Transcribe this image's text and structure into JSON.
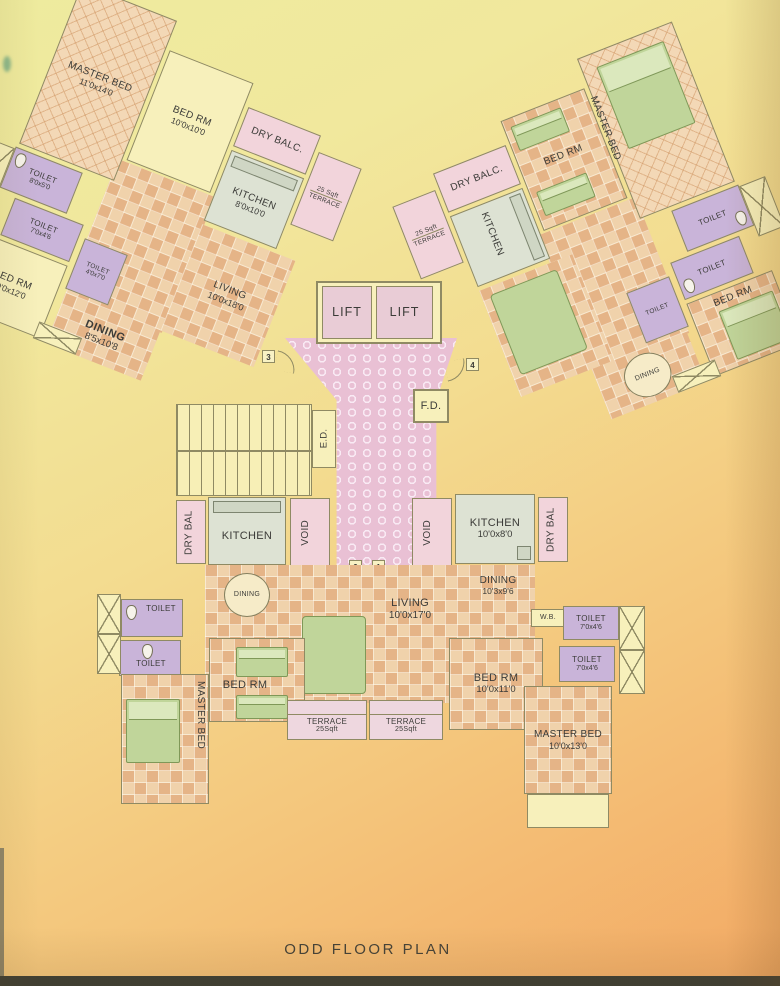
{
  "title": "ODD FLOOR PLAN",
  "core": {
    "lift_left": "LIFT",
    "lift_right": "LIFT",
    "fire_duct": "F.D.",
    "electrical_duct": "E.D.",
    "markers": {
      "m1": "1",
      "m2": "2",
      "m3": "3",
      "m4": "4"
    }
  },
  "wing_top_left": {
    "master_bed": {
      "label": "MASTER BED",
      "dims": "11'0x14'0"
    },
    "toilet_1": {
      "label": "TOILET",
      "dims": "8'0x5'0"
    },
    "bed_rm_1": {
      "label": "BED RM",
      "dims": "10'0x10'0"
    },
    "dry_balc": {
      "label": "DRY BALC."
    },
    "kitchen": {
      "label": "KITCHEN",
      "dims": "8'0x10'0"
    },
    "terrace": {
      "line1": "25 Sqft",
      "line2": "TERRACE"
    },
    "toilet_2": {
      "label": "TOILET",
      "dims": "7'0x4'6"
    },
    "toilet_3": {
      "label": "TOILET",
      "dims": "4'0x7'0"
    },
    "bed_rm_2": {
      "label": "BED RM",
      "dims": "10'0x12'0"
    },
    "dining": {
      "label": "DINING",
      "dims": "8'5x10'8"
    },
    "living": {
      "label": "LIVING",
      "dims": "10'0x18'0"
    }
  },
  "wing_top_right": {
    "terrace": {
      "line1": "25 Sqft",
      "line2": "TERRACE"
    },
    "dry_balc": {
      "label": "DRY BALC."
    },
    "kitchen": {
      "label": "KITCHEN"
    },
    "bed_rm_1": {
      "label": "BED RM"
    },
    "master_bed": {
      "label": "MASTER BED"
    },
    "toilet_1": {
      "label": "TOILET"
    },
    "toilet_2": {
      "label": "TOILET"
    },
    "toilet_3": {
      "label": "TOILET"
    },
    "bed_rm_2": {
      "label": "BED RM"
    },
    "dining": {
      "label": "DINING"
    }
  },
  "bottom_left_unit": {
    "dry_bal": {
      "label": "DRY BAL"
    },
    "kitchen": {
      "label": "KITCHEN"
    },
    "void": {
      "label": "VOID"
    },
    "dining": {
      "label": "DINING"
    },
    "toilet_1": {
      "label": "TOILET"
    },
    "toilet_2": {
      "label": "TOILET"
    },
    "master_bed": {
      "label": "MASTER BED"
    },
    "bed_rm": {
      "label": "BED RM"
    },
    "terrace": {
      "line1": "TERRACE",
      "line2": "25Sqft"
    }
  },
  "bottom_right_unit": {
    "void": {
      "label": "VOID"
    },
    "kitchen": {
      "label": "KITCHEN",
      "dims": "10'0x8'0"
    },
    "dry_bal": {
      "label": "DRY BAL"
    },
    "living": {
      "label": "LIVING",
      "dims": "10'0x17'0"
    },
    "dining": {
      "label": "DINING",
      "dims": "10'3x9'6"
    },
    "wb": {
      "label": "W.B."
    },
    "toilet_1": {
      "label": "TOILET",
      "dims": "7'0x4'6"
    },
    "toilet_2": {
      "label": "TOILET",
      "dims": "7'0x4'6"
    },
    "bed_rm": {
      "label": "BED RM",
      "dims": "10'0x11'0"
    },
    "master_bed": {
      "label": "MASTER BED",
      "dims": "10'0x13'0"
    },
    "terrace": {
      "line1": "TERRACE",
      "line2": "25Sqft"
    }
  },
  "colors": {
    "paper_top": "#eeeb9e",
    "paper_bottom": "#f3a964",
    "room_plain": "#f7f0bb",
    "tile_peach": "#e5b487",
    "toilet_purple": "#c9b4d9",
    "balcony_pink": "#f2d4db",
    "kitchen_gray": "#dde2d3",
    "lobby_pink": "#e9c0d4",
    "furniture_green": "#c0d59a",
    "wall": "#8f8a63",
    "text": "#3b3b38"
  }
}
